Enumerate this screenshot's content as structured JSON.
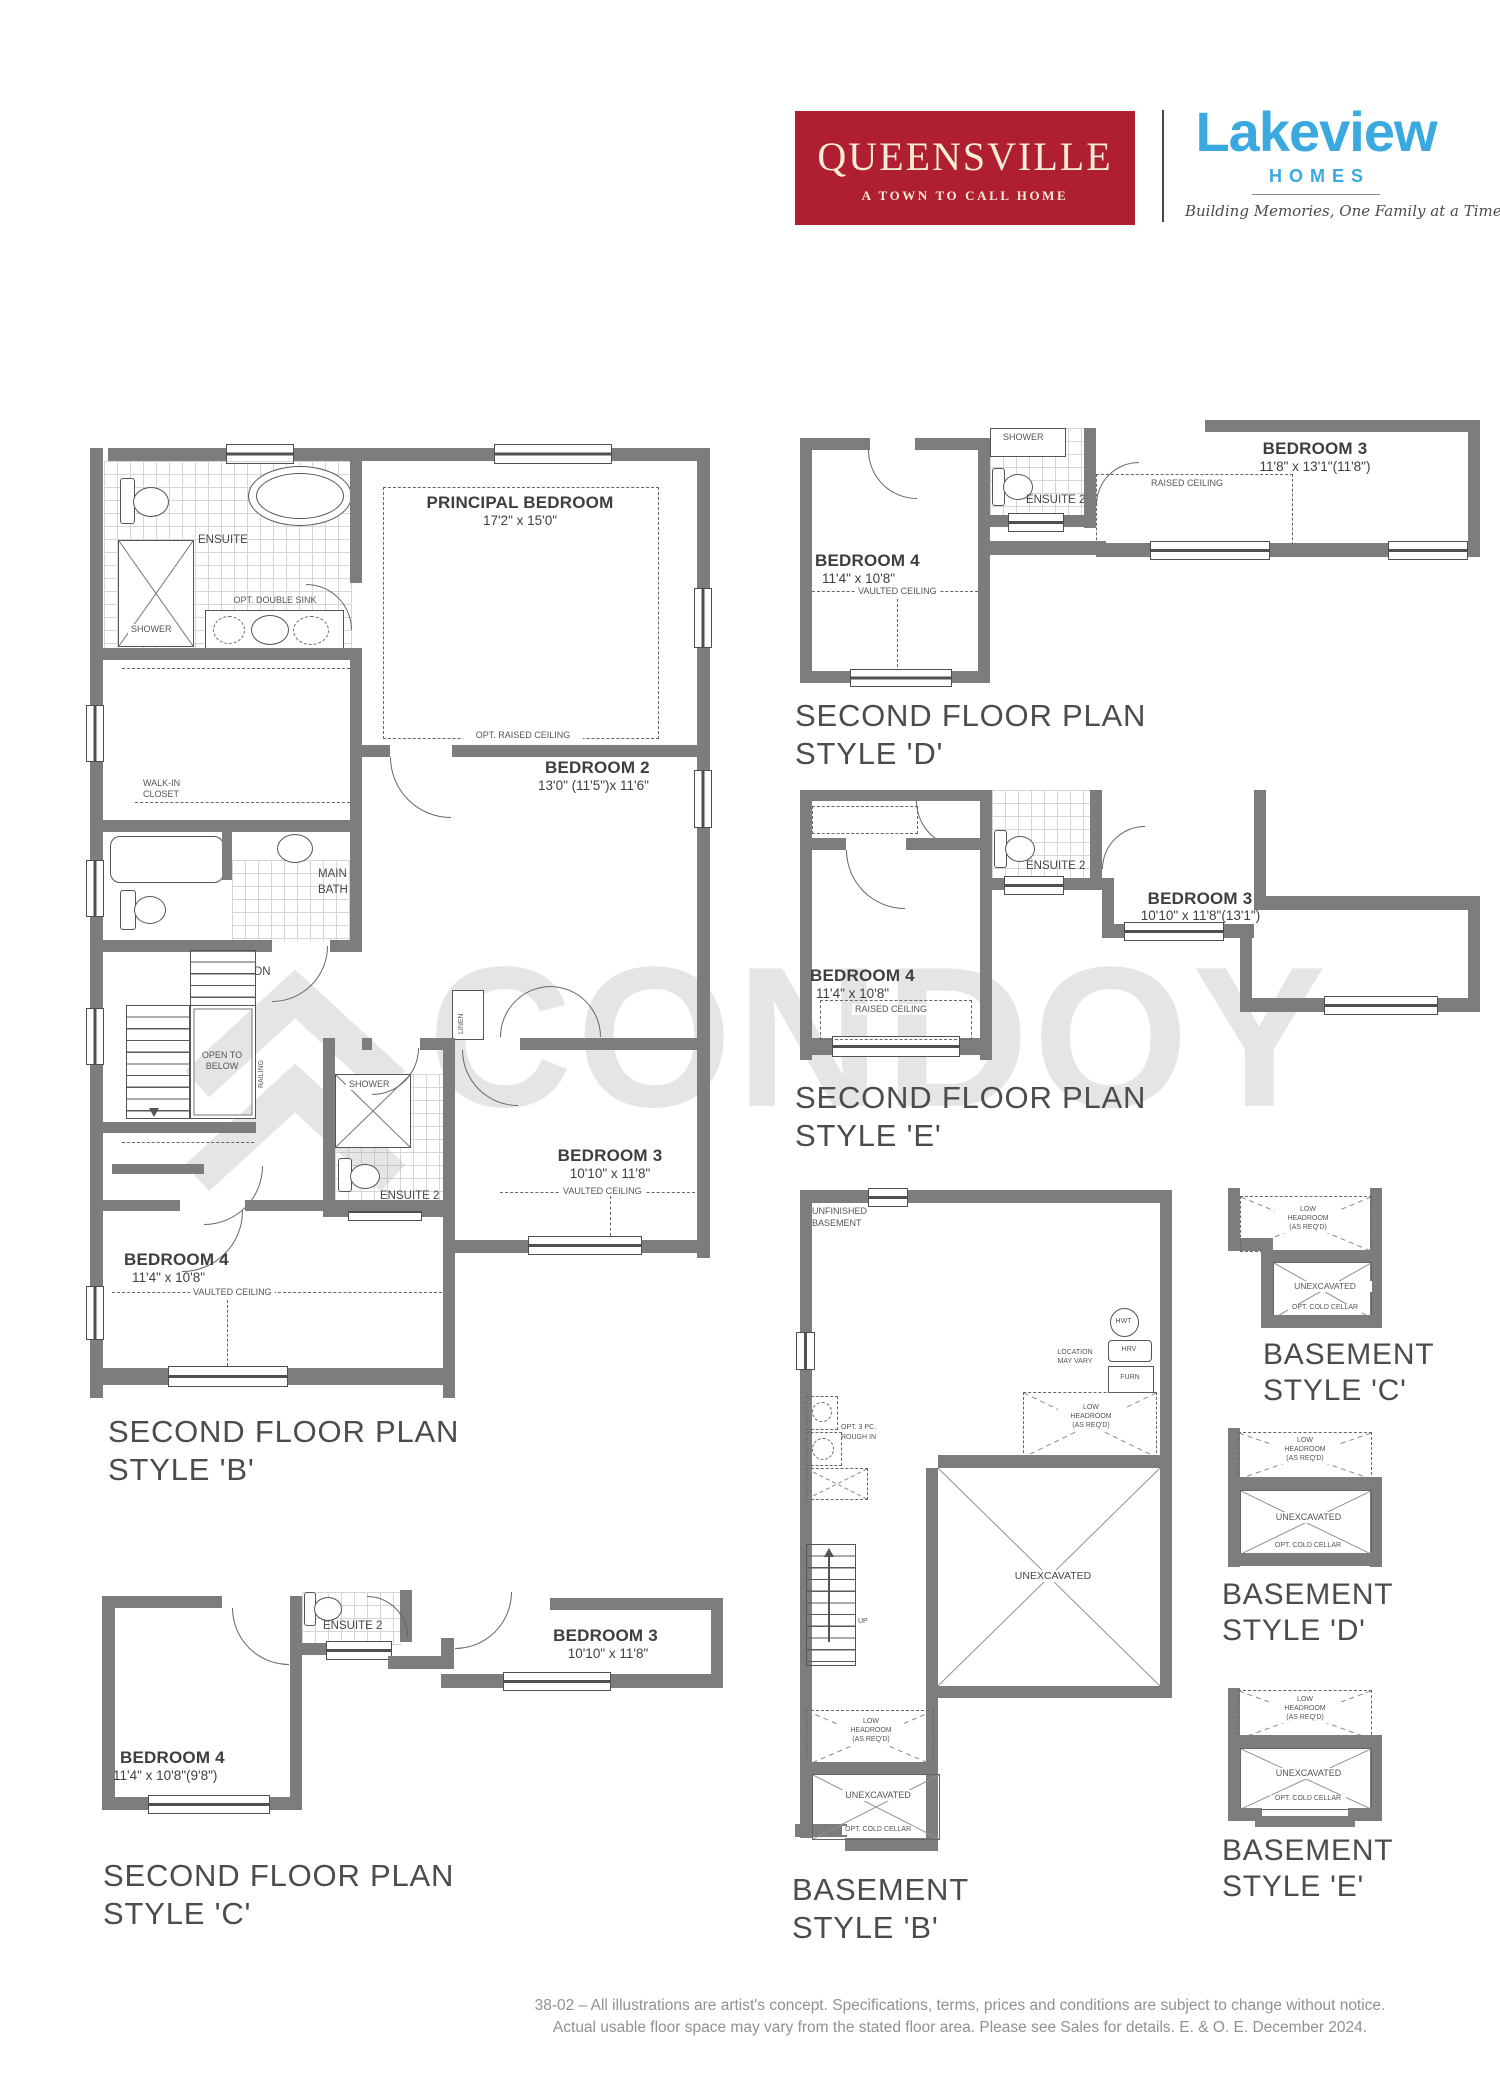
{
  "header": {
    "queensville": {
      "title": "QUEENSVILLE",
      "subtitle": "A TOWN TO CALL HOME",
      "bg_color": "#B01E31",
      "text_color": "#F4ECD7"
    },
    "lakeview": {
      "name": "Lakeview",
      "homes": "HOMES",
      "tagline": "Building Memories, One Family at a Time",
      "blue": "#3AA9DF"
    }
  },
  "watermark": {
    "text": "CONDOY"
  },
  "shared": {
    "second_floor_plan": "SECOND FLOOR PLAN",
    "basement": "BASEMENT",
    "unexcavated": "UNEXCAVATED",
    "opt_cold_cellar": "OPT. COLD CELLAR",
    "low": "LOW",
    "headroom": "HEADROOM",
    "as_reqd": "(AS REQ'D)",
    "vaulted_ceiling": "VAULTED CEILING",
    "raised_ceiling": "RAISED CEILING",
    "ensuite2": "ENSUITE 2",
    "shower": "SHOWER",
    "bedroom3": "BEDROOM 3",
    "bedroom4": "BEDROOM 4"
  },
  "style_b": {
    "style_label": "STYLE 'B'",
    "principal_name": "PRINCIPAL BEDROOM",
    "principal_dims": "17'2\" x 15'0\"",
    "opt_raised_ceiling": "OPT. RAISED CEILING",
    "ensuite": "ENSUITE",
    "opt_double_sink": "OPT. DOUBLE SINK",
    "walkin1": "WALK-IN",
    "walkin2": "CLOSET",
    "main1": "MAIN",
    "main2": "BATH",
    "bedroom2_name": "BEDROOM 2",
    "bedroom2_dims": "13'0\" (11'5\")x 11'6\"",
    "dn": "DN",
    "open1": "OPEN TO",
    "open2": "BELOW",
    "railing": "RAILING",
    "linen": "LINEN",
    "bedroom3_dims": "10'10\" x 11'8\"",
    "bedroom4_dims": "11'4\" x 10'8\""
  },
  "style_d": {
    "style_label": "STYLE 'D'",
    "bedroom4_dims": "11'4\" x 10'8\"",
    "bedroom3_dims": "11'8\" x 13'1\"(11'8\")"
  },
  "style_e": {
    "style_label": "STYLE 'E'",
    "bedroom4_dims": "11'4\" x 10'8\"",
    "bedroom3_dims": "10'10\" x 11'8\"(13'1\")"
  },
  "style_c": {
    "style_label": "STYLE 'C'",
    "bedroom4_dims": "11'4\" x 10'8\"(9'8\")",
    "bedroom3_dims": "10'10\" x 11'8\""
  },
  "basement_b": {
    "style_label": "STYLE 'B'",
    "unfinished1": "UNFINISHED",
    "unfinished2": "BASEMENT",
    "hwt": "HWT",
    "hrv": "HRV",
    "furn": "FURN",
    "loc1": "LOCATION",
    "loc2": "MAY VARY",
    "rough1": "OPT. 3 PC.",
    "rough2": "ROUGH IN",
    "up": "UP"
  },
  "basement_c": {
    "style_label": "STYLE 'C'"
  },
  "basement_d": {
    "style_label": "STYLE 'D'"
  },
  "basement_e": {
    "style_label": "STYLE 'E'"
  },
  "footer": {
    "line1": "38-02 – All illustrations are artist's concept. Specifications, terms, prices and conditions are subject to change without notice.",
    "line2": "Actual usable floor space may vary from the stated floor area. Please see Sales for details.  E. & O. E. December 2024."
  }
}
